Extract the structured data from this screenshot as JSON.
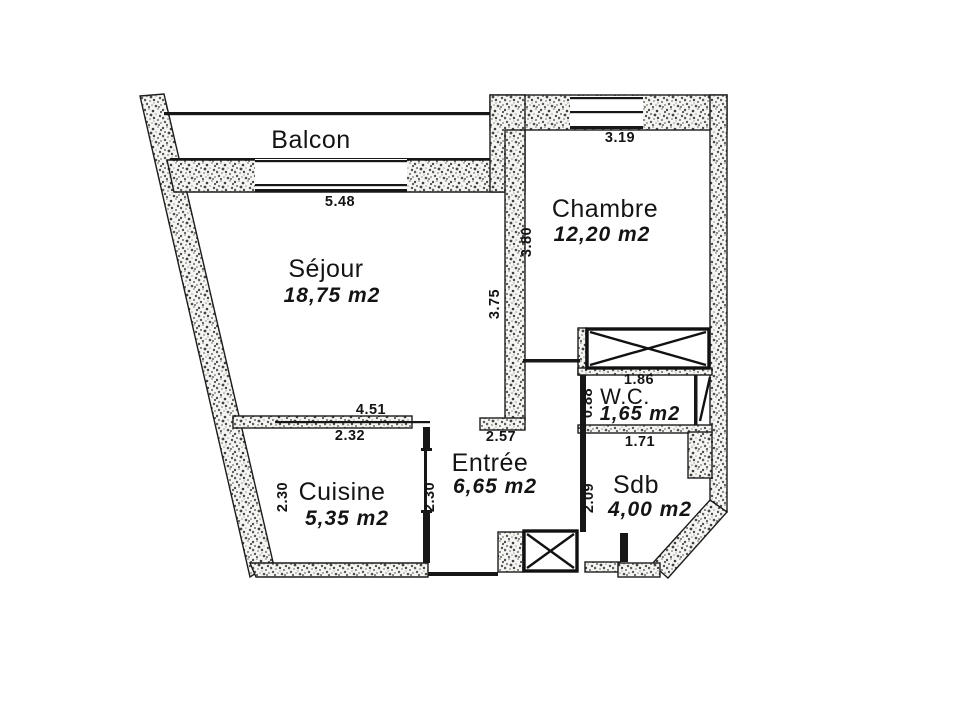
{
  "plan": {
    "balcony": {
      "label": "Balcon"
    },
    "rooms": {
      "sejour": {
        "name": "Séjour",
        "area": "18,75 m2"
      },
      "chambre": {
        "name": "Chambre",
        "area": "12,20 m2"
      },
      "cuisine": {
        "name": "Cuisine",
        "area": "5,35 m2"
      },
      "entree": {
        "name": "Entrée",
        "area": "6,65 m2"
      },
      "wc": {
        "name": "W.C.",
        "area": "1,65 m2"
      },
      "sdb": {
        "name": "Sdb",
        "area": "4,00 m2"
      }
    },
    "dimensions": {
      "sejour_top": "5.48",
      "chambre_top": "3.19",
      "chambre_left": "3.80",
      "sejour_right": "3.75",
      "sejour_bottom": "4.51",
      "cuisine_top": "2.32",
      "entree_top": "2.57",
      "cuisine_left": "2.30",
      "cuisine_right": "2.30",
      "wc_top": "1.86",
      "wc_left": "0.88",
      "sdb_top": "1.71",
      "sdb_left": "2.09"
    },
    "colors": {
      "ink": "#141414",
      "background": "#ffffff"
    }
  }
}
